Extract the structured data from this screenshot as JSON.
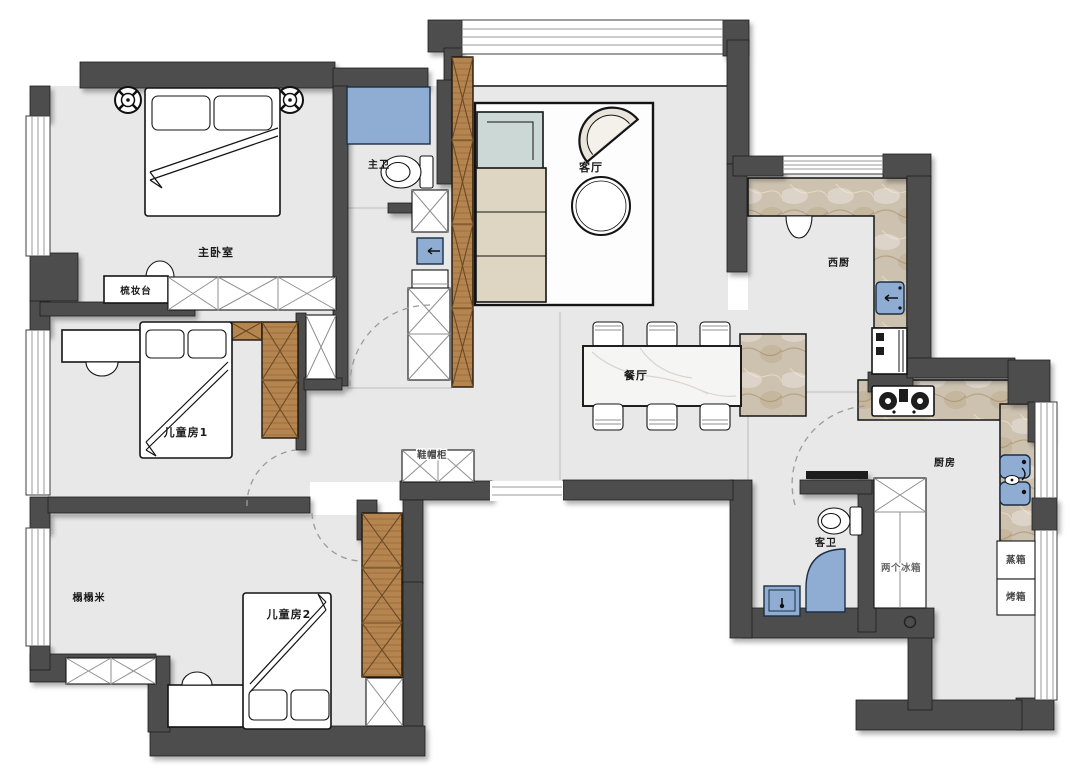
{
  "plan": {
    "labels": {
      "master_bedroom": "主卧室",
      "dressing_table": "梳妆台",
      "master_bath": "主卫",
      "living_room": "客厅",
      "west_kitchen": "西厨",
      "dining_room": "餐厅",
      "kids_room_1": "儿童房1",
      "shoe_cabinet": "鞋帽柜",
      "tatami": "榻榻米",
      "kids_room_2": "儿童房2",
      "guest_bath": "客卫",
      "kitchen": "厨房",
      "two_fridges": "两个冰箱",
      "steamer": "蒸箱",
      "oven": "烤箱"
    },
    "colors": {
      "wall": "#4d4d4d",
      "floor": "#e8e8e8",
      "fixture_blue": "#8fadd2",
      "wood": "#b5854f",
      "marble": "#cdc2b0"
    }
  }
}
